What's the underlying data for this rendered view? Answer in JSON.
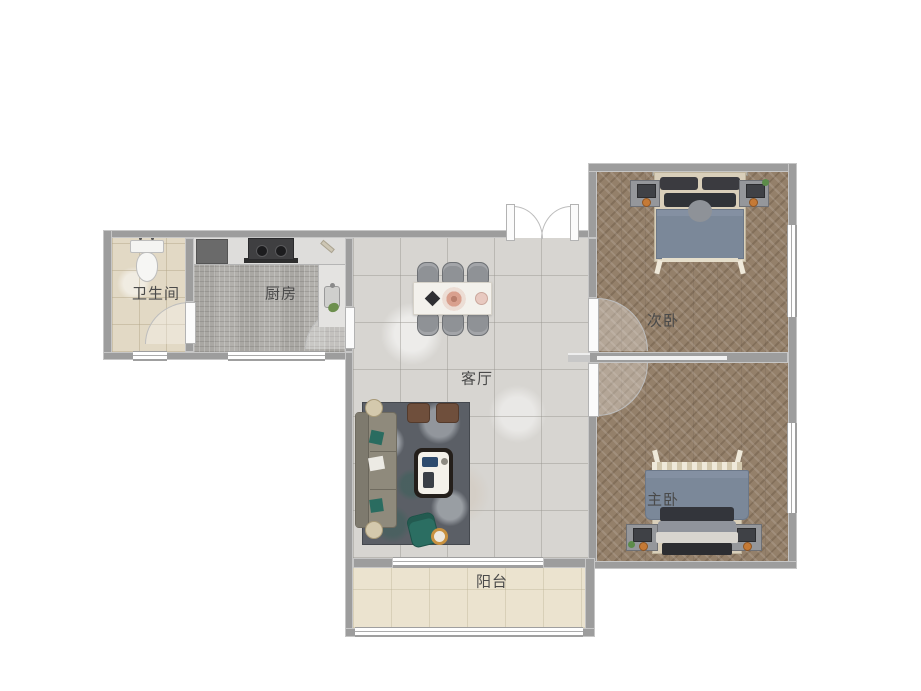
{
  "meta": {
    "type": "floor-plan",
    "language": "zh-CN"
  },
  "rooms": {
    "bathroom": {
      "label": "卫生间"
    },
    "kitchen": {
      "label": "厨房"
    },
    "living_room": {
      "label": "客厅"
    },
    "secondary_bedroom": {
      "label": "次卧"
    },
    "master_bedroom": {
      "label": "主卧"
    },
    "balcony": {
      "label": "阳台"
    }
  },
  "palette": {
    "background": "#ffffff",
    "wall": "#9d9d9d",
    "bathroom_floor": "#e2d9c5",
    "kitchen_floor": "#b2b0ac",
    "living_floor": "#d7d5d1",
    "bedroom_floor": "#94806a",
    "balcony_floor": "#ebe3cf",
    "window": "#ffffff",
    "duvet_blue": "#7b8899",
    "rug_gray": "#5b5f66",
    "accent_teal": "#2b6e62",
    "ottoman_brown": "#6f4f3c",
    "lamp_orange": "#c57a36",
    "label_text": "#4a4a4a"
  }
}
